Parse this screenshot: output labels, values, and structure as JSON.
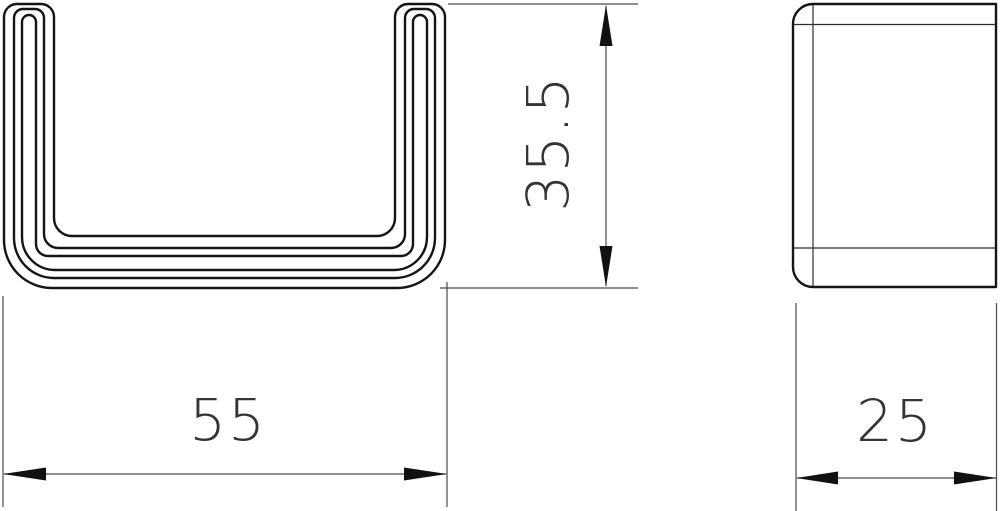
{
  "theme": {
    "background": "#ffffff",
    "outline_color": "#141414",
    "edge_line_color": "#2e2e2e",
    "dimension_line_color": "#4a4a4a",
    "arrow_color": "#111111",
    "text_color": "#333333"
  },
  "drawing": {
    "type": "technical-dimension-drawing",
    "views": {
      "front_view": {
        "description": "U-channel profile cross-section with three nested material contours",
        "width_label": "55",
        "height_label": "35.5"
      },
      "side_view": {
        "description": "side elevation with rounded left corners and edge lines",
        "width_label": "25"
      }
    },
    "dimensions": {
      "width": {
        "label": "55",
        "orientation": "horizontal"
      },
      "height": {
        "label": "35.5",
        "orientation": "vertical"
      },
      "depth": {
        "label": "25",
        "orientation": "horizontal"
      }
    }
  }
}
